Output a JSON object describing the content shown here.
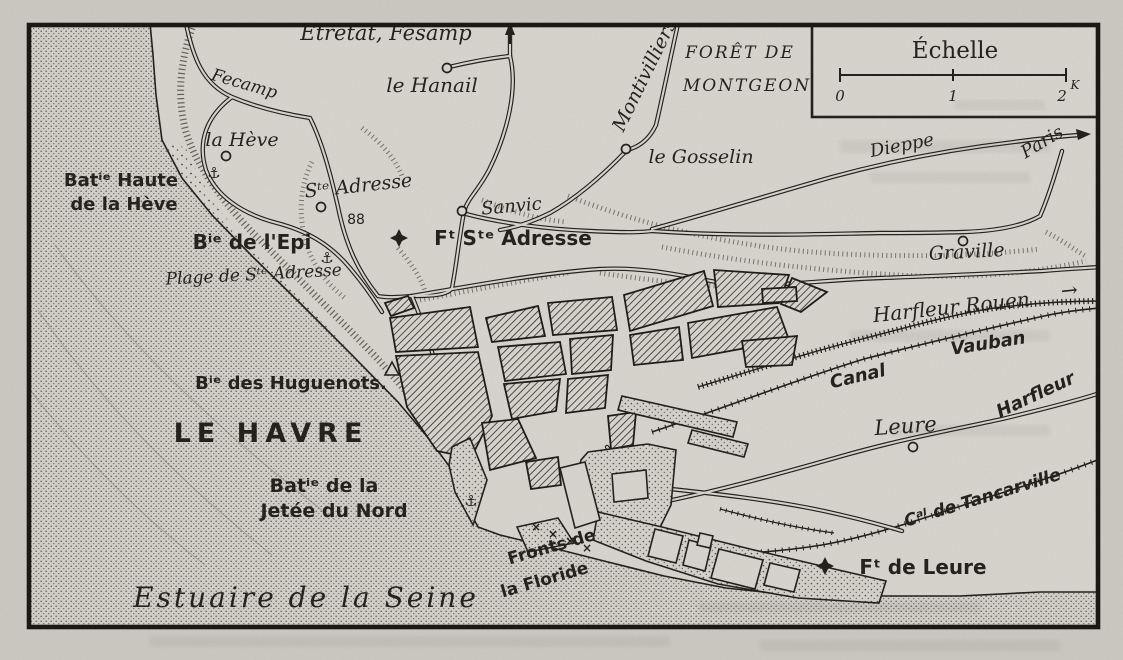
{
  "document": {
    "kind": "scanned engraved map",
    "city": "LE HAVRE"
  },
  "colors": {
    "paper": "#d8d5ce",
    "ink": "#201e19",
    "sea_dot": "#5f5b54"
  },
  "scale_box": {
    "title": "Échelle",
    "ticks": [
      "0",
      "1",
      "2"
    ],
    "unit": "K"
  },
  "labels": {
    "etretat": "Etretat, Fésamp",
    "fecamp": "Fecamp",
    "le_hanail": "le Hanail",
    "foret_line1": "FORÊT DE",
    "foret_line2": "MONTGEON",
    "montivilliers": "Montivilliers",
    "le_gosselin": "le Gosselin",
    "dieppe": "Dieppe",
    "paris": "Paris",
    "graville": "Graville",
    "la_heve": "la Hève",
    "batterie_haute_line1": "Batⁱᵉ Haute",
    "batterie_haute_line2": "de la Hève",
    "ste_adresse": "Sᵗᵉ Adresse",
    "altitude": "88",
    "sanvic": "Sanvic",
    "fort_ste_adresse": "Fᵗ Sᵗᵉ Adresse",
    "batterie_epi": "Bⁱᵉ de l'Epi",
    "plage": "Plage de Sᵗᵉ Adresse",
    "batterie_huguenots": "Bⁱᵉ des Huguenots.",
    "city_title": "LE HAVRE",
    "batterie_jetee_line1": "Batⁱᵉ de la",
    "batterie_jetee_line2": "Jetée du Nord",
    "fronts_line1": "Fronts de",
    "fronts_line2": "la Floride",
    "estuaire": "Estuaire de la Seine",
    "railway": "Harfleur  Rouen",
    "railway_arrow": "→",
    "canal_word1": "Canal",
    "canal_word2": "Vauban",
    "leure": "Leure",
    "harfleur_road": "Harfleur",
    "tancarville": "Cᵃˡ de Tancarville",
    "fort_leure": "Fᵗ de Leure"
  },
  "symbols": {
    "anchor": "⚓",
    "cross": "×"
  }
}
